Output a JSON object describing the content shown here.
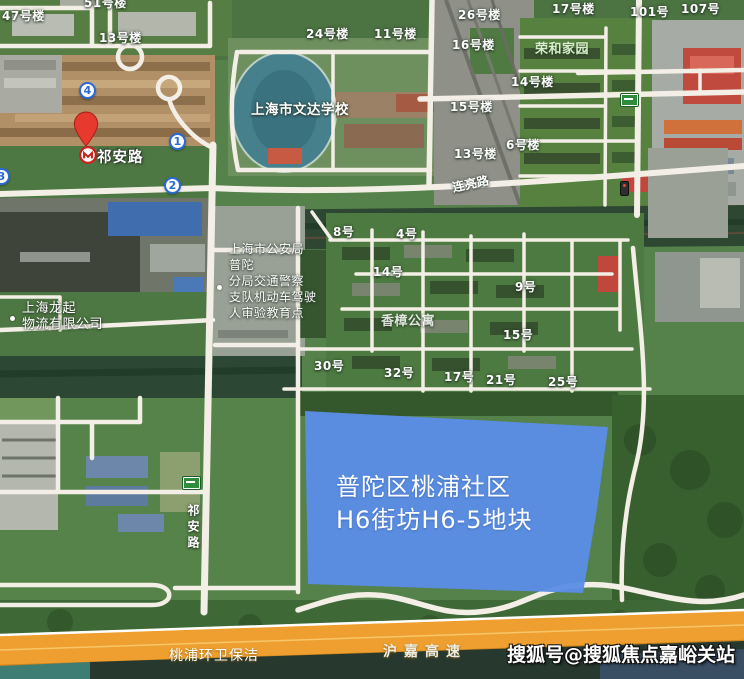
{
  "colors": {
    "parcel_blue": "#5b8ee6",
    "highway_orange": "#ee9f2f",
    "pin_red": "#e8392e",
    "metro_red": "#c8231c",
    "route_marker_blue": "#2a6ad4",
    "road_sign_green": "#2f8c3c"
  },
  "parcel_overlay": {
    "line1": "普陀区桃浦社区",
    "line2": "H6街坊H6-5地块"
  },
  "metro_station": {
    "label": "祁安路"
  },
  "route_markers": [
    {
      "number": "4"
    },
    {
      "number": "1"
    },
    {
      "number": "2"
    },
    {
      "number": "3"
    }
  ],
  "building_labels": [
    {
      "text": "47号楼"
    },
    {
      "text": "51号楼"
    },
    {
      "text": "13号楼"
    },
    {
      "text": "24号楼"
    },
    {
      "text": "11号楼"
    },
    {
      "text": "26号楼"
    },
    {
      "text": "16号楼"
    },
    {
      "text": "15号楼"
    },
    {
      "text": "13号楼"
    },
    {
      "text": "17号楼"
    },
    {
      "text": "101号"
    },
    {
      "text": "107号"
    },
    {
      "text": "14号楼"
    },
    {
      "text": "6号楼"
    }
  ],
  "estate_unit_labels": [
    {
      "text": "8号"
    },
    {
      "text": "4号"
    },
    {
      "text": "14号"
    },
    {
      "text": "9号"
    },
    {
      "text": "15号"
    },
    {
      "text": "30号"
    },
    {
      "text": "32号"
    },
    {
      "text": "17号"
    },
    {
      "text": "21号"
    },
    {
      "text": "25号"
    }
  ],
  "poi": {
    "school": "上海市文达学校",
    "residence": "荣和家园",
    "apartment": "香樟公寓",
    "logistics_lines": [
      "上海龙起",
      "物流有限公司"
    ],
    "police_lines": [
      "上海市公安局",
      "普陀",
      "分局交通警察",
      "支队机动车驾驶",
      "人审验教育点"
    ]
  },
  "road_labels": {
    "lianliang_road": "连亮路",
    "qian_road_vertical": "祁安路",
    "expressway": "沪嘉高速",
    "sanitation": "桃浦环卫保洁"
  },
  "watermark": "搜狐号@搜狐焦点嘉峪关站"
}
